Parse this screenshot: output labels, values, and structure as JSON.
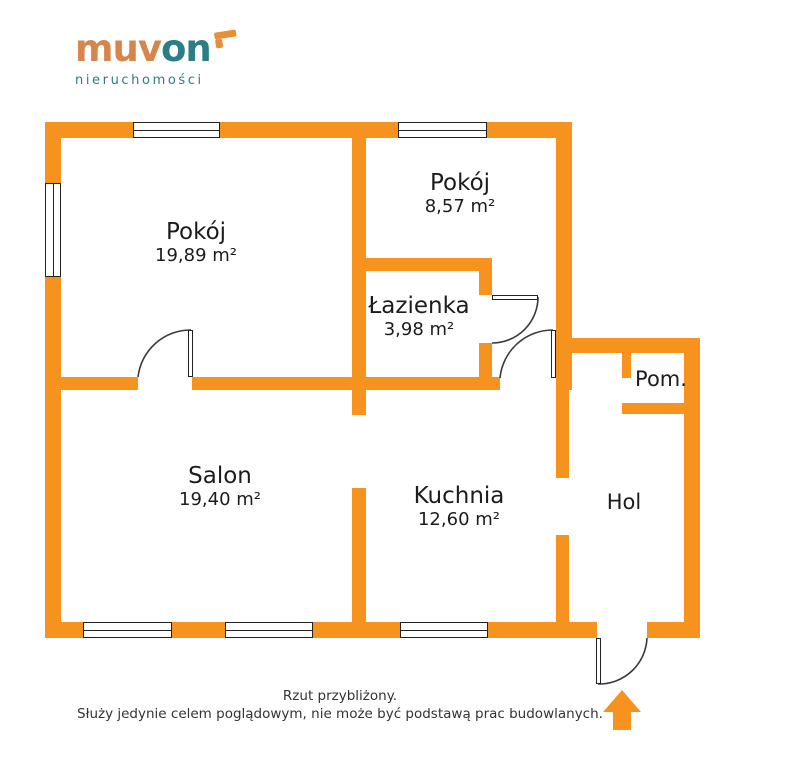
{
  "logo": {
    "part1": "muv",
    "part2": "on",
    "tagline": "nieruchomości",
    "mark_icon": "corner-arrow-icon"
  },
  "rooms": [
    {
      "id": "pokoj-1",
      "name": "Pokój",
      "area": "19,89 m²"
    },
    {
      "id": "pokoj-2",
      "name": "Pokój",
      "area": "8,57 m²"
    },
    {
      "id": "lazienka",
      "name": "Łazienka",
      "area": "3,98 m²"
    },
    {
      "id": "salon",
      "name": "Salon",
      "area": "19,40 m²"
    },
    {
      "id": "kuchnia",
      "name": "Kuchnia",
      "area": "12,60 m²"
    },
    {
      "id": "hol",
      "name": "Hol",
      "area": ""
    },
    {
      "id": "pom",
      "name": "Pom.",
      "area": ""
    }
  ],
  "footer": {
    "line1": "Rzut przybliżony.",
    "line2": "Służy jedynie celem poglądowym, nie może być podstawą prac budowlanych."
  },
  "entrance_icon": "up-arrow-icon",
  "colors": {
    "wall": "#F6921E",
    "logo-orange": "#D6854C",
    "logo-teal": "#2B7D86",
    "logo-mark": "#E88F35",
    "label": "#1C1C1C",
    "footer-text": "#333333",
    "door-line": "#3A3A3A"
  }
}
